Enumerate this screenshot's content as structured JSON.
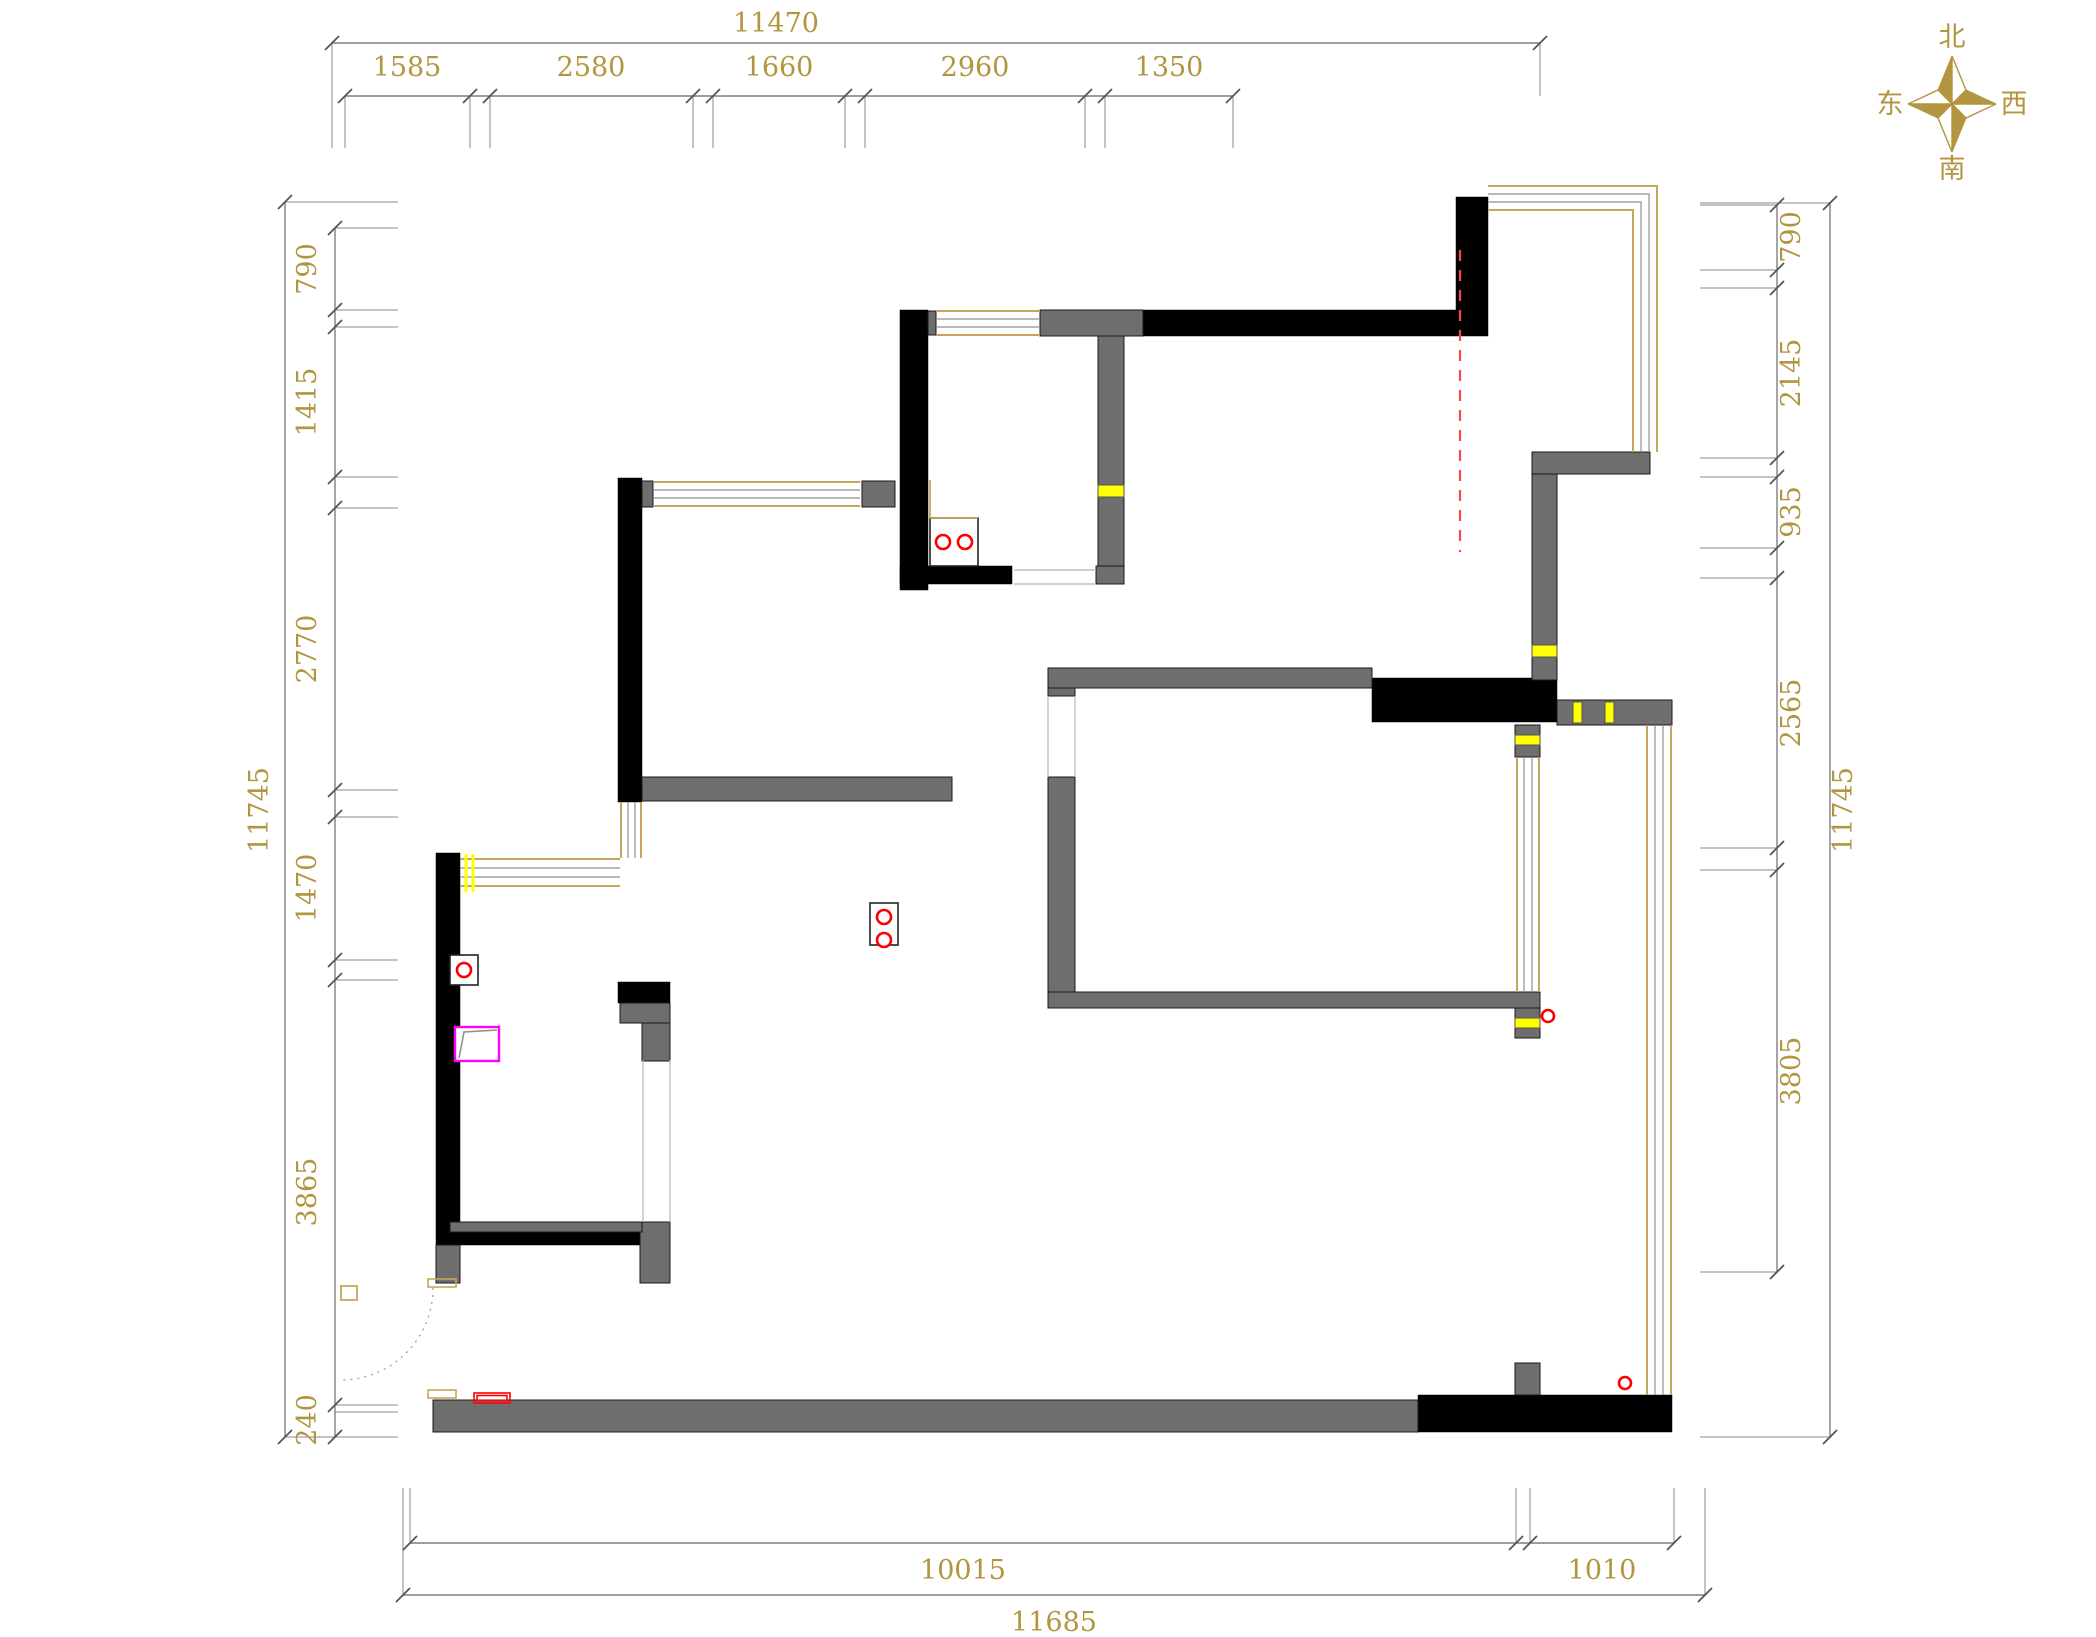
{
  "drawing": {
    "kind": "residential floor plan"
  },
  "compass": {
    "north": "北",
    "south": "南",
    "east": "东",
    "west": "西"
  },
  "dims": {
    "top": {
      "total": "11470",
      "segments": [
        "1585",
        "2580",
        "1660",
        "2960",
        "1350"
      ]
    },
    "left": {
      "total": "11745",
      "segments": [
        "790",
        "1415",
        "2770",
        "1470",
        "3865",
        "240"
      ]
    },
    "right": {
      "total": "11745",
      "segments": [
        "790",
        "2145",
        "935",
        "2565",
        "3805"
      ]
    },
    "bottom": {
      "total": "11685",
      "segments": [
        "10015",
        "1010"
      ]
    }
  },
  "colors": {
    "dim_text": "#b3953f",
    "dim_line": "#7f7f7f",
    "wall_black": "#000000",
    "wall_gray": "#6e6e6e",
    "window_frame": "#c8a55f",
    "highlight_yellow": "#ffff00",
    "symbol_red": "#ff0000",
    "symbol_magenta": "#ff00ff"
  }
}
